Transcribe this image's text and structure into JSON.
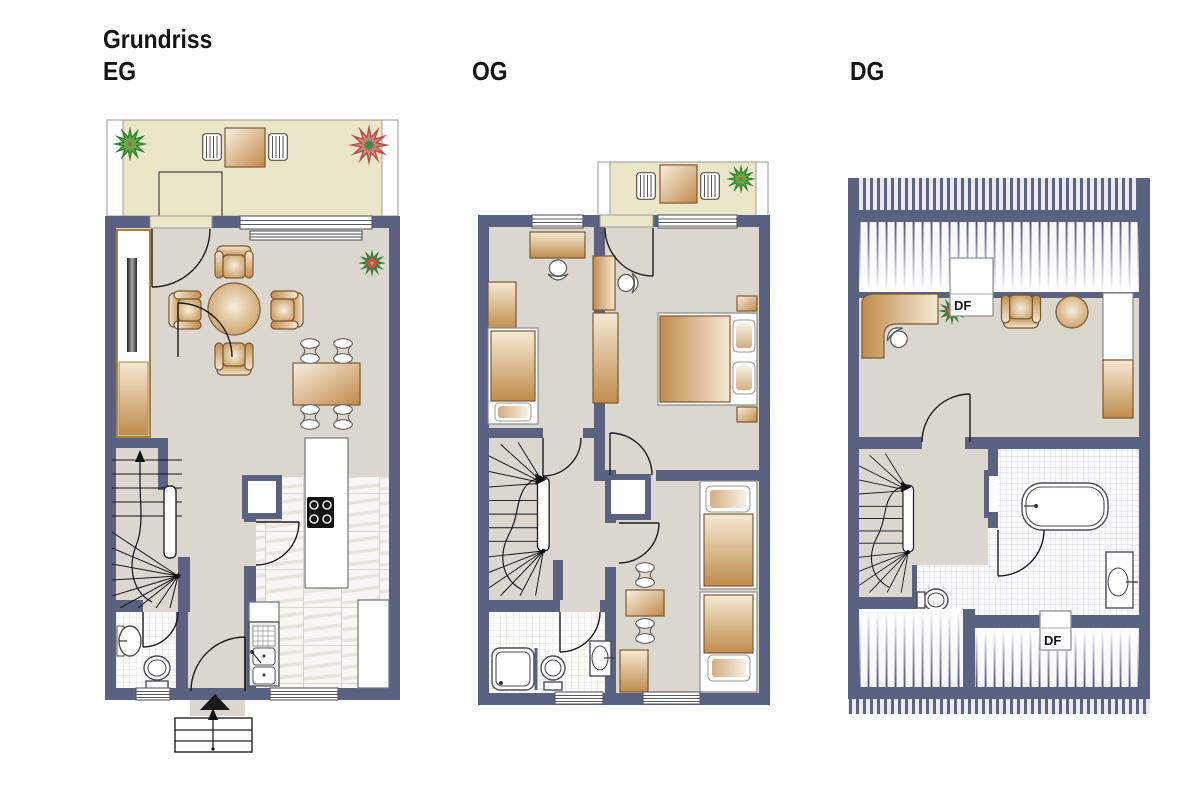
{
  "header": {
    "title": "Grundriss"
  },
  "floors": [
    {
      "id": "eg",
      "label": "EG"
    },
    {
      "id": "og",
      "label": "OG"
    },
    {
      "id": "dg",
      "label": "DG"
    }
  ],
  "labels": {
    "roof_window_1": "DF",
    "roof_window_2": "DF"
  },
  "colors": {
    "wall": "#5a6181",
    "floor": "#dbd7cf",
    "outdoor": "#ebe6c8",
    "furniture": "#c89a5e",
    "furniture_border": "#7a5a30",
    "line": "#1b1b1b",
    "window_frame": "#55595f",
    "tile_grout": "#c6c5bc",
    "bath_tile_grout": "#ced0db",
    "roof_stripe": "#5c6480",
    "stair_rail": "#222222",
    "plant_green": "#2e7d32",
    "plant_red": "#b5524f"
  }
}
